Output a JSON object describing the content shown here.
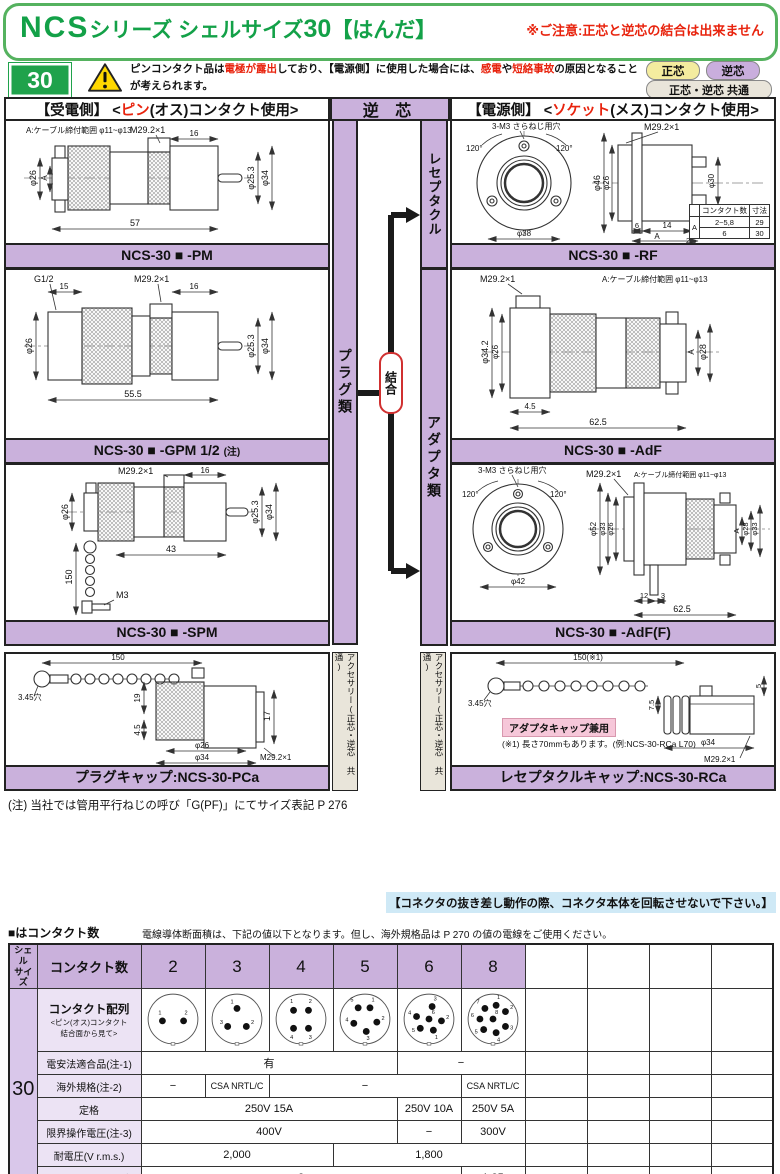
{
  "colors": {
    "green": "#13a148",
    "lavender": "#cab1dc",
    "lavender_light": "#ece3f4",
    "tag_yellow": "#f4ec9f",
    "tag_lavender": "#c9aedd",
    "tag_gray": "#e9e5da",
    "red": "#e8230d",
    "note_blue": "#cfe9f6",
    "badge_pink": "#f6c7d9"
  },
  "header": {
    "title_parts": [
      "NCS",
      "シリーズ シェルサイズ",
      "30",
      "【はんだ】"
    ],
    "caution": "※ご注意:正芯と逆芯の結合は出来ません",
    "shell_badge": "30",
    "warning": {
      "l1a": "ピンコンタクト品は",
      "l1b": "電極が露出",
      "l1c": "しており、【電源側】に使用した場合には、",
      "l1d": "感電",
      "l1e": "や",
      "l1f": "短絡事故",
      "l1g": "の原因となることが考えられます。",
      "l2": "事故防止のため、【電源側】にはソケットコンタクト品を、【受電側】にはピンコンタクト品をご使用下さい。"
    },
    "tags": {
      "normal": "正芯",
      "reverse": "逆芯",
      "common": "正芯・逆芯 共通"
    }
  },
  "sections": {
    "left_pre": "【受電側】 <",
    "left_red": "ピン",
    "left_post": "(オス)コンタクト使用>",
    "center": "逆 芯",
    "right_pre": "【電源側】 <",
    "right_red": "ソケット",
    "right_post": "(メス)コンタクト使用>",
    "plug_group": "プラグ類",
    "receptacle_group": "レセプタクル",
    "adapter_group": "アダプタ類",
    "join": "結合",
    "accessory_left": "アクセサリー(正芯・逆芯 共通)",
    "accessory_right": "アクセサリー(正芯・逆芯 共通)"
  },
  "panels": {
    "pm": {
      "title": "NCS-30 ■ -PM",
      "dims": [
        "A:ケーブル締付範囲 φ11~φ13",
        "M29.2×1",
        "16",
        "φ26",
        "A",
        "φ25.3",
        "φ34",
        "57"
      ]
    },
    "gpm": {
      "title": "NCS-30 ■ -GPM 1/2",
      "title_note": "(注)",
      "dims": [
        "G1/2",
        "15",
        "M29.2×1",
        "16",
        "φ26",
        "φ25.3",
        "φ34",
        "55.5"
      ]
    },
    "spm": {
      "title": "NCS-30 ■ -SPM",
      "dims": [
        "M29.2×1",
        "16",
        "φ26",
        "150",
        "43",
        "M3",
        "φ25.3",
        "φ34"
      ]
    },
    "pca": {
      "title": "プラグキャップ:NCS-30-PCa",
      "dims": [
        "150",
        "3.45穴",
        "19",
        "4.5",
        "φ26",
        "φ34",
        "17",
        "M29.2×1"
      ]
    },
    "rf": {
      "title": "NCS-30 ■ -RF",
      "dims": [
        "3-M3 さらねじ用穴",
        "M29.2×1",
        "120°",
        "120°",
        "φ38",
        "φ46",
        "φ26",
        "φ30",
        "6",
        "14",
        "2.5",
        "A"
      ],
      "inset": {
        "h1": "コンタクト数",
        "h2": "寸法",
        "a": "A",
        "r1c": "2~5,8",
        "r1v": "29",
        "r2c": "6",
        "r2v": "30"
      }
    },
    "adf": {
      "title": "NCS-30 ■ -AdF",
      "dims": [
        "M29.2×1",
        "A:ケーブル締付範囲 φ11~φ13",
        "φ34.2",
        "φ26",
        "A",
        "φ28",
        "4.5",
        "62.5"
      ]
    },
    "adff": {
      "title": "NCS-30 ■ -AdF(F)",
      "dims": [
        "3-M3 さらねじ用穴",
        "M29.2×1",
        "A:ケーブル締付範囲 φ11~φ13",
        "120°",
        "120°",
        "φ42",
        "φ52",
        "φ33",
        "φ26",
        "A",
        "φ28",
        "φ33",
        "12",
        "3",
        "62.5"
      ]
    },
    "rca": {
      "title": "レセプタクルキャップ:NCS-30-RCa",
      "dims": [
        "150(※1)",
        "3.45穴",
        "7.5",
        "φ34",
        "5",
        "M29.2×1"
      ],
      "badge": "アダプタキャップ兼用",
      "note": "(※1) 長さ70mmもあります。(例:NCS-30-RCa L70)"
    }
  },
  "footnote": "(注) 当社では管用平行ねじの呼び「G(PF)」にてサイズ表記 P 276",
  "rotate_note": "【コネクタの抜き差し動作の際、コネクタ本体を回転させないで下さい。】",
  "spec_table": {
    "intro_left": "■はコンタクト数",
    "intro_right": "電線導体断面積は、下記の値以下となります。但し、海外規格品は P 270 の値の電線をご使用ください。",
    "shell_header_1": "シェル",
    "shell_header_2": "サイズ",
    "shell_size": "30",
    "count_label": "コンタクト数",
    "counts": [
      "2",
      "3",
      "4",
      "5",
      "6",
      "8"
    ],
    "arrangement_label": "コンタクト配列",
    "arrangement_sub1": "<ピン(オス)コンタクト",
    "arrangement_sub2": "結合面から見て>",
    "arrangements": [
      {
        "pins": [
          {
            "n": "1",
            "x": 28,
            "y": 48,
            "lx": 24,
            "ly": 38
          },
          {
            "n": "2",
            "x": 62,
            "y": 48,
            "lx": 66,
            "ly": 38
          }
        ]
      },
      {
        "pins": [
          {
            "n": "1",
            "x": 45,
            "y": 28,
            "lx": 37,
            "ly": 20
          },
          {
            "n": "2",
            "x": 60,
            "y": 57,
            "lx": 70,
            "ly": 53
          },
          {
            "n": "3",
            "x": 30,
            "y": 57,
            "lx": 20,
            "ly": 53
          }
        ]
      },
      {
        "pins": [
          {
            "n": "1",
            "x": 33,
            "y": 31,
            "lx": 30,
            "ly": 19
          },
          {
            "n": "2",
            "x": 57,
            "y": 31,
            "lx": 60,
            "ly": 19
          },
          {
            "n": "3",
            "x": 57,
            "y": 60,
            "lx": 60,
            "ly": 77
          },
          {
            "n": "4",
            "x": 33,
            "y": 60,
            "lx": 30,
            "ly": 77
          }
        ]
      },
      {
        "pins": [
          {
            "n": "1",
            "x": 53,
            "y": 27,
            "lx": 58,
            "ly": 17
          },
          {
            "n": "2",
            "x": 64,
            "y": 50,
            "lx": 74,
            "ly": 47
          },
          {
            "n": "3",
            "x": 47,
            "y": 65,
            "lx": 50,
            "ly": 79
          },
          {
            "n": "4",
            "x": 27,
            "y": 52,
            "lx": 16,
            "ly": 49
          },
          {
            "n": "5",
            "x": 34,
            "y": 27,
            "lx": 24,
            "ly": 17
          }
        ]
      },
      {
        "pins": [
          {
            "n": "3",
            "x": 50,
            "y": 25,
            "lx": 55,
            "ly": 15
          },
          {
            "n": "6",
            "x": 45,
            "y": 45,
            "lx": 52,
            "ly": 37
          },
          {
            "n": "4",
            "x": 25,
            "y": 41,
            "lx": 14,
            "ly": 38
          },
          {
            "n": "2",
            "x": 65,
            "y": 48,
            "lx": 75,
            "ly": 45
          },
          {
            "n": "5",
            "x": 31,
            "y": 60,
            "lx": 20,
            "ly": 66
          },
          {
            "n": "1",
            "x": 52,
            "y": 63,
            "lx": 57,
            "ly": 77
          }
        ]
      },
      {
        "pins": [
          {
            "n": "1",
            "x": 50,
            "y": 23,
            "lx": 54,
            "ly": 13
          },
          {
            "n": "2",
            "x": 65,
            "y": 33,
            "lx": 75,
            "ly": 29
          },
          {
            "n": "3",
            "x": 65,
            "y": 57,
            "lx": 75,
            "ly": 62
          },
          {
            "n": "4",
            "x": 50,
            "y": 67,
            "lx": 54,
            "ly": 81
          },
          {
            "n": "5",
            "x": 30,
            "y": 62,
            "lx": 18,
            "ly": 68
          },
          {
            "n": "6",
            "x": 24,
            "y": 45,
            "lx": 12,
            "ly": 42
          },
          {
            "n": "7",
            "x": 32,
            "y": 28,
            "lx": 21,
            "ly": 20
          },
          {
            "n": "8",
            "x": 45,
            "y": 45,
            "lx": 51,
            "ly": 37
          }
        ]
      }
    ],
    "rows": [
      {
        "label": "電安法適合品(注-1)",
        "cells": [
          {
            "t": "有",
            "s": 4
          },
          {
            "t": "−",
            "s": 2
          }
        ]
      },
      {
        "label": "海外規格(注-2)",
        "cells": [
          {
            "t": "−",
            "s": 1
          },
          {
            "t": "CSA NRTL/C",
            "s": 1
          },
          {
            "t": "−",
            "s": 3
          },
          {
            "t": "CSA NRTL/C",
            "s": 1
          }
        ]
      },
      {
        "label": "定格",
        "cells": [
          {
            "t": "250V 15A",
            "s": 4
          },
          {
            "t": "250V 10A",
            "s": 1
          },
          {
            "t": "250V 5A",
            "s": 1
          }
        ]
      },
      {
        "label": "限界操作電圧(注-3)",
        "cells": [
          {
            "t": "400V",
            "s": 4
          },
          {
            "t": "−",
            "s": 1
          },
          {
            "t": "300V",
            "s": 1
          }
        ]
      },
      {
        "label": "耐電圧(V r.m.s.)",
        "cells": [
          {
            "t": "2,000",
            "s": 3
          },
          {
            "t": "1,800",
            "s": 3
          }
        ]
      },
      {
        "label": "電線導体断面積(㎟)",
        "cells": [
          {
            "t": "2",
            "s": 5
          },
          {
            "t": "1.25",
            "s": 1
          }
        ]
      }
    ]
  }
}
